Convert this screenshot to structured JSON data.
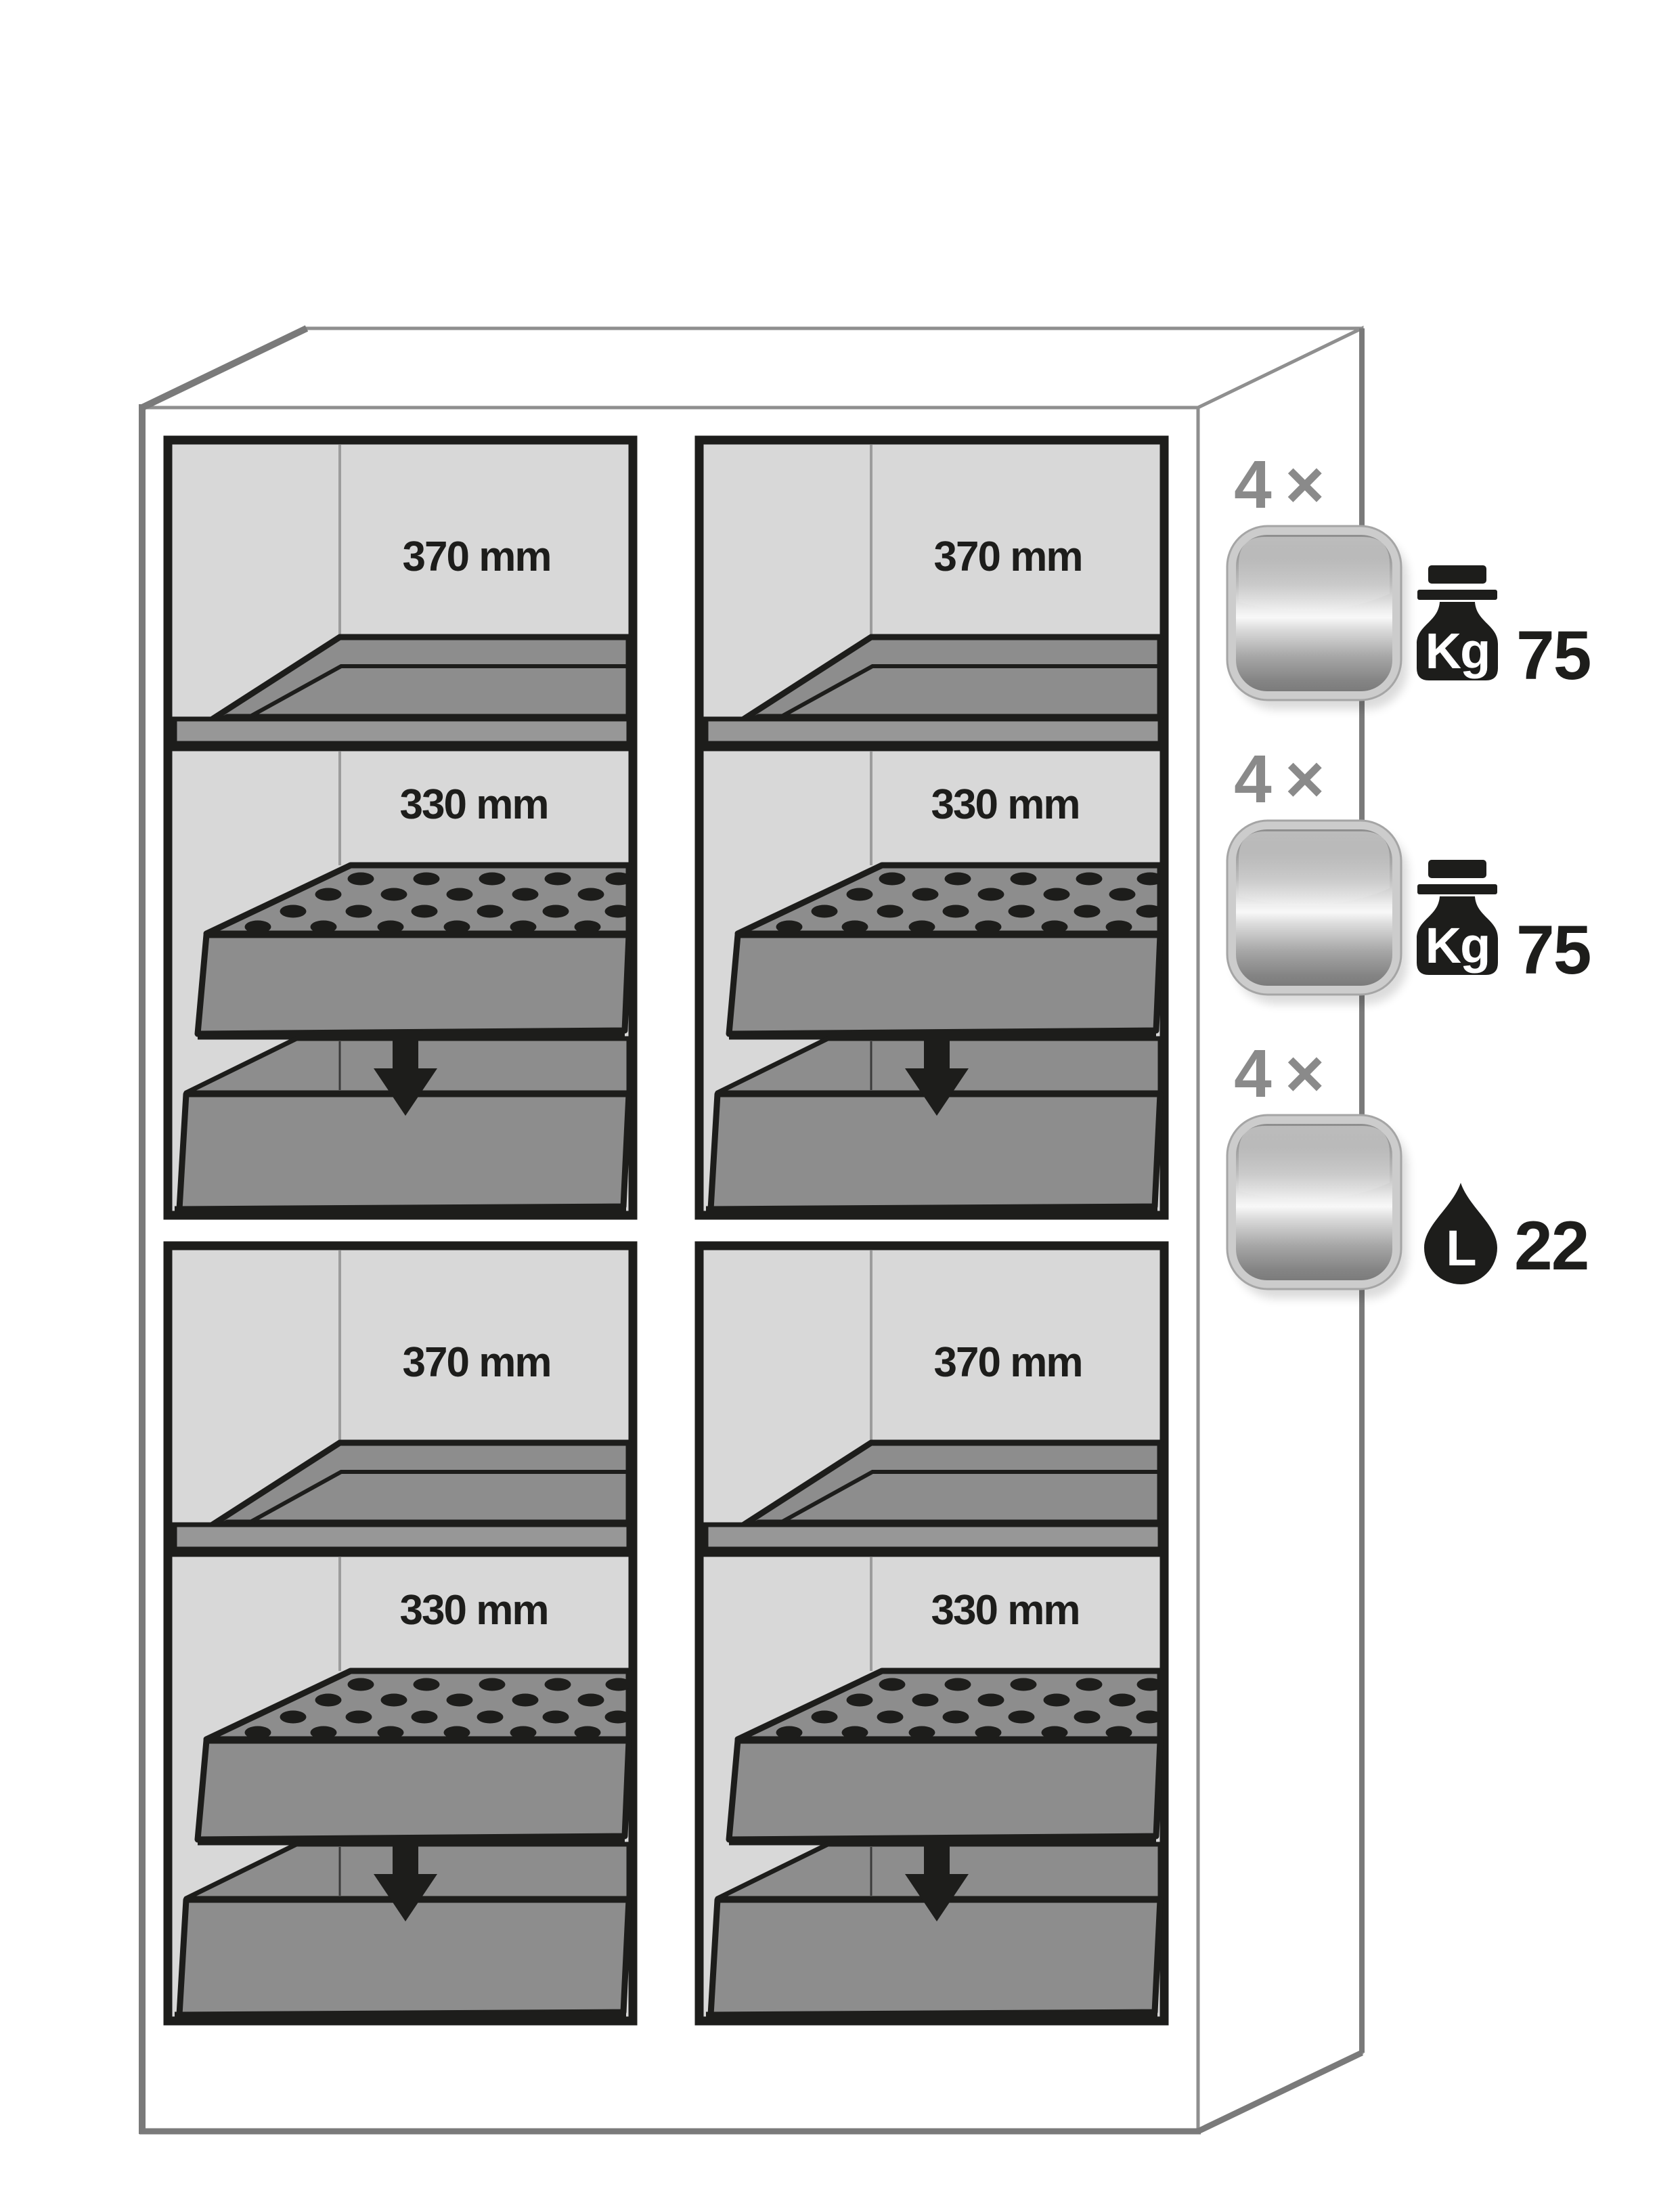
{
  "diagram": {
    "title_none": "",
    "compartments": [
      {
        "position": "top-left",
        "shelf_clearance": "370 mm",
        "sump_clearance": "330 mm"
      },
      {
        "position": "top-right",
        "shelf_clearance": "370 mm",
        "sump_clearance": "330 mm"
      },
      {
        "position": "bottom-left",
        "shelf_clearance": "370 mm",
        "sump_clearance": "330 mm"
      },
      {
        "position": "bottom-right",
        "shelf_clearance": "370 mm",
        "sump_clearance": "330 mm"
      }
    ],
    "legend": [
      {
        "count": "4 ×",
        "item_icon": "metal-tray-icon",
        "spec_icon": "weight-kg-icon",
        "spec_unit": "Kg",
        "spec_value": "75"
      },
      {
        "count": "4 ×",
        "item_icon": "metal-tray-icon",
        "spec_icon": "weight-kg-icon",
        "spec_unit": "Kg",
        "spec_value": "75"
      },
      {
        "count": "4 ×",
        "item_icon": "metal-tray-icon",
        "spec_icon": "liquid-drop-icon",
        "spec_unit": "L",
        "spec_value": "22"
      }
    ],
    "colors": {
      "outline_gray": "#7a7a7a",
      "thin_line_gray": "#8f8f8f",
      "interior_gray": "#d8d8d8",
      "fixture_gray": "#8d8d8d",
      "ink_black": "#1d1d1b",
      "label_gray": "#8a8a8a"
    }
  }
}
